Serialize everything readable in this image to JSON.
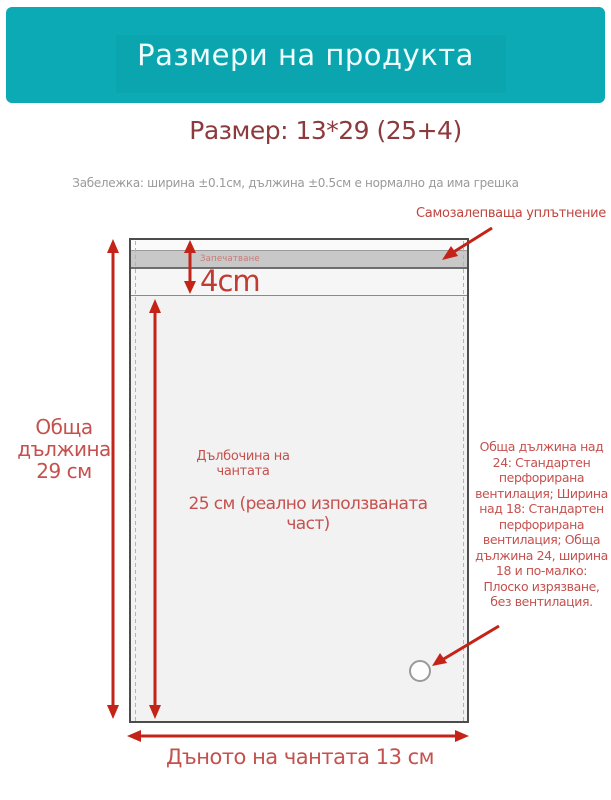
{
  "header": {
    "title": "Размери на продукта"
  },
  "main": {
    "size_title": "Размер: 13*29 (25+4)",
    "note": "Забележка: ширина ±0.1см, дължина ±0.5см е нормално да има грешка"
  },
  "diagram": {
    "seal_callout": "Самозалепваща уплътнение",
    "seal_strip_label": "Запечатване",
    "flap_height_label": "4cm",
    "total_length_label": "Обща\nдължина\n29 см",
    "depth_title": "Дълбочина на\nчантата",
    "depth_value": "25 см (реално използваната част)",
    "ventilation_note": "Обща дължина над 24: Стандартен перфорирана вентилация; Ширина над 18: Стандартен перфорирана вентилация; Обща дължина 24, ширина 18 и по-малко: Плоско изрязване, без вентилация.",
    "bottom_width_label": "Дъното на чантата 13 см"
  },
  "colors": {
    "header_bg": "#0caab4",
    "header_text": "#effefe",
    "size_title_text": "#8d3a3e",
    "label_red": "#c5514e",
    "arrow_red": "#c42318",
    "note_gray": "#9a9a9a",
    "seal_strip_fill": "#c8c8c8",
    "bag_fill": "#f2f2f2"
  }
}
